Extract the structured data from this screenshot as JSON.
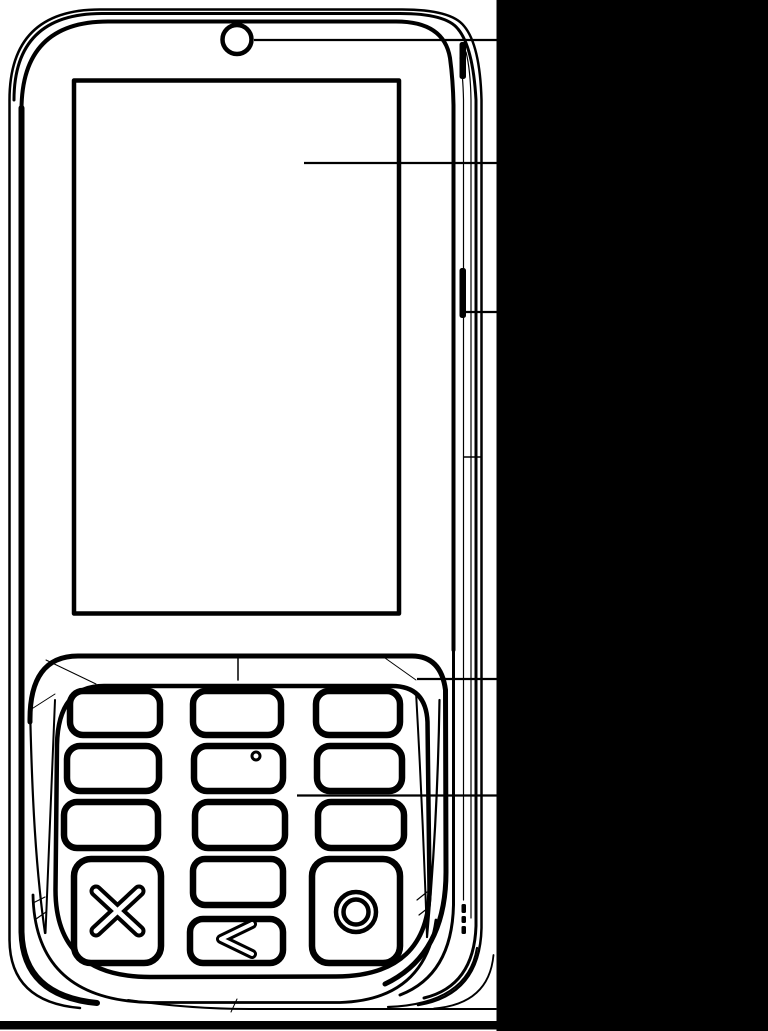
{
  "figure": {
    "kind": "technical-line-drawing",
    "subject": "slider handset with touchscreen, front camera and 12-key keypad (front view)",
    "ink_color": "#000000",
    "paper_color": "#ffffff"
  },
  "masks": {
    "right_panel_color": "#000000",
    "bottom_bar_color": "#000000"
  },
  "device": {
    "camera_count": 1,
    "side_button_count": 2,
    "screen": "blank rectangular display"
  },
  "keypad": {
    "number_key_count": 9,
    "rows": 4,
    "columns": 3,
    "tactile_dot": "small circle on center key of second row",
    "special_keys": {
      "cancel_glyph": "X",
      "zero_glyph": "",
      "back_glyph": "<",
      "ok_glyph": "O"
    }
  },
  "callouts": {
    "count": 5,
    "targets": [
      "front-camera",
      "display-screen",
      "side-button",
      "keypad-tray-edge",
      "keypad-keys"
    ]
  }
}
